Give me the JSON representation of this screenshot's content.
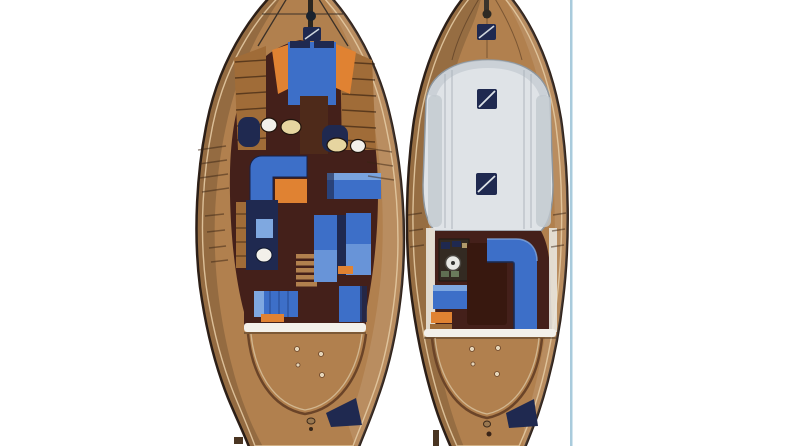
{
  "page": {
    "kind": "scanned brochure figure",
    "content": "two top-view deck plans of a motor yacht, no text"
  },
  "figure": {
    "plans": [
      {
        "id": "lower-deck-plan",
        "position": "left",
        "parts": [
          "bow-pulpit",
          "anchor-windlass",
          "foredeck-hatch",
          "v-berth-bed",
          "side-shelves",
          "wardrobes",
          "washbasins",
          "head-toilet",
          "l-shaped-settee",
          "salon-table",
          "starboard-sofa",
          "twin-guest-berths",
          "companionway-steps",
          "aft-cabin-bed",
          "aft-wardrobe",
          "transom-beam",
          "aft-deck",
          "swim-platform"
        ]
      },
      {
        "id": "main-deck-plan",
        "position": "right",
        "parts": [
          "bowsprit",
          "anchor-windlass",
          "foredeck-hatch",
          "coachroof",
          "coachroof-hatch-forward",
          "coachroof-hatch-aft",
          "helm-console",
          "steering-wheel",
          "cockpit-table",
          "l-shaped-cockpit-settee",
          "port-bench",
          "aft-beam",
          "aft-deck",
          "swim-platform"
        ]
      }
    ]
  },
  "colors": {
    "background": "#ffffff",
    "divider": "#a9cbdc",
    "hull_outline": "#30221a",
    "deck_wood": "#b1804e",
    "cabin_floor": "#44201a",
    "furniture_brown": "#4e2a1a",
    "cabinet_wood": "#a06c38",
    "upholstery_blue": "#3d6fc8",
    "upholstery_blue_light": "#7fa8e0",
    "navy": "#1f2950",
    "accent_orange": "#e08232",
    "fixture_white": "#f2f0ea",
    "fixture_cream": "#e6d5a0",
    "coachroof": "#dfe3e7",
    "coachroof_shade": "#c2c9d0",
    "trim_white": "#f3f0ea",
    "helm_dark": "#332a22",
    "table_dark": "#38180f"
  }
}
